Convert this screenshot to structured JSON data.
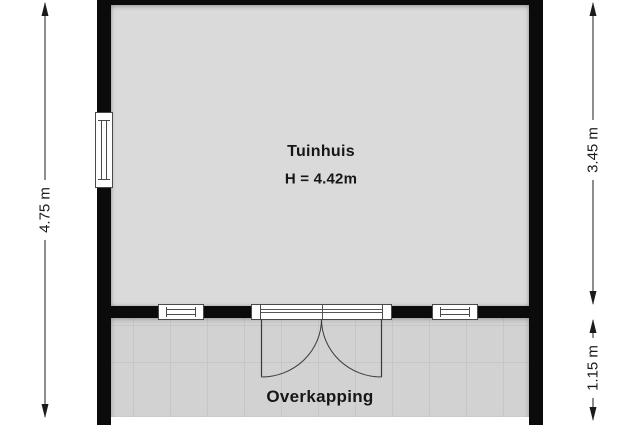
{
  "floorplan": {
    "title": "Tuinhuis floor plan",
    "rooms": {
      "tuinhuis": {
        "label": "Tuinhuis",
        "height_label": "H = 4.42m"
      },
      "overkapping": {
        "label": "Overkapping"
      }
    },
    "dimensions": {
      "left": "4.75 m",
      "right_top": "3.45 m",
      "right_bottom": "1.15 m"
    },
    "features": {
      "windows": [
        "left-wall-window",
        "middle-wall-window-1",
        "middle-wall-window-2"
      ],
      "doors": [
        "double-swing-door"
      ]
    },
    "colors": {
      "wall": "#0b0b0b",
      "tuinhuis_floor": "#dadada",
      "overkapping_floor": "#d2d2d2",
      "line": "#1b1b1b"
    }
  }
}
